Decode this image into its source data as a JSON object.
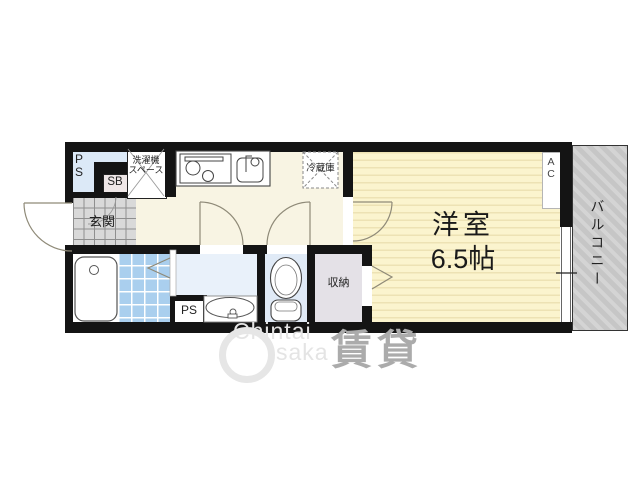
{
  "floorplan": {
    "rooms": {
      "main_room": {
        "name": "洋室",
        "size": "6.5帖"
      },
      "balcony": {
        "label": "バルコニー"
      },
      "entrance": {
        "label": "玄関"
      },
      "closet": {
        "label": "収納"
      },
      "washer_space": {
        "label": "洗濯機\nスペース"
      },
      "fridge": {
        "label": "冷蔵庫"
      },
      "ac_unit": {
        "label": "A\nC"
      },
      "pipe_space_top": {
        "label": "P\nS"
      },
      "pipe_space_bottom": {
        "label": "PS"
      },
      "shoe_box": {
        "label": "SB"
      }
    },
    "colors": {
      "wall": "#141414",
      "main_room_fill": "#FBF4CE",
      "main_room_stripe": "#EDE2B4",
      "kitchen_floor": "#F8F4E3",
      "balcony_fill": "#C7C7C7",
      "bath_tile": "#AACFEE",
      "washroom_fill": "#E9F1FA",
      "toilet_fill": "#E0EAF6",
      "closet_fill": "#E4E1E7",
      "ps_shaft_fill": "#DCE9F7",
      "shoe_box_fill": "#EFE7E7",
      "genkan_tile": "#D9D9D9"
    }
  },
  "watermark": {
    "line1": "Chintai",
    "line2": "saka",
    "kanji": "賃貸"
  }
}
